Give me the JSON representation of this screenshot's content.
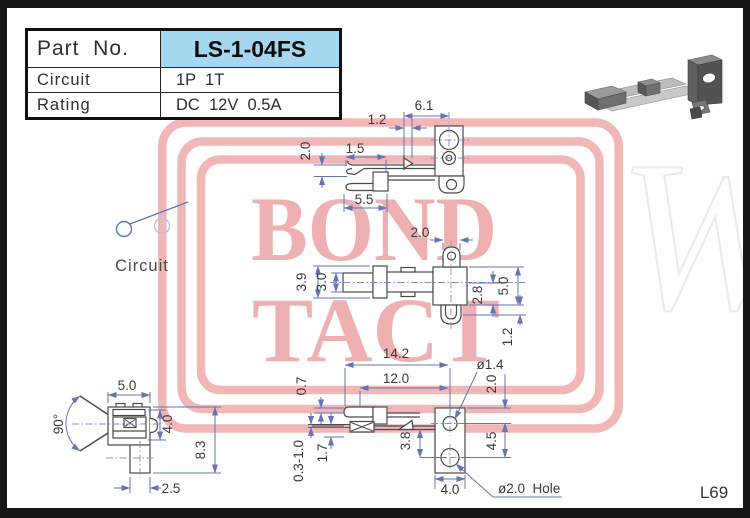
{
  "page": {
    "code": "L69"
  },
  "colors": {
    "watermark_pink": "#f1b6b6",
    "watermark_text_pink": "#eeb0b0",
    "highlight_blue": "#a6d7f0",
    "dim_line_blue": "#6474b4",
    "part_line_gray": "#4a4a4a"
  },
  "table": {
    "rows": [
      {
        "label": "Part  No.",
        "value": "LS-1-04FS"
      },
      {
        "label": "Circuit",
        "value": "1P  1T"
      },
      {
        "label": "Rating",
        "value": "DC  12V  0.5A"
      }
    ]
  },
  "watermark": {
    "word1": "BOND",
    "word2": "TACT",
    "ghost_letter": "W"
  },
  "circuit": {
    "label": "Circuit"
  },
  "dims": {
    "v1": {
      "d1": "6.1",
      "d2": "1.2",
      "d3": "1.5",
      "d4": "2.0",
      "d5": "5.5"
    },
    "v2": {
      "d1": "2.0",
      "d2": "3.9",
      "d3": "3.0",
      "d4": "2.8",
      "d5": "5.0",
      "d6": "1.2"
    },
    "v3": {
      "d1": "14.2",
      "d2": "12.0",
      "d3": "ø1.4",
      "d4": "2.0",
      "d5": "4.5",
      "d6": "3.8",
      "d7": "0.7",
      "d8": "0.3-1.0",
      "d9": "1.7",
      "d10": "4.0",
      "d11": "ø2.0  Hole"
    },
    "v4": {
      "d1": "5.0",
      "d2": "90°",
      "d3": "4.0",
      "d4": "8.3",
      "d5": "2.5"
    }
  }
}
